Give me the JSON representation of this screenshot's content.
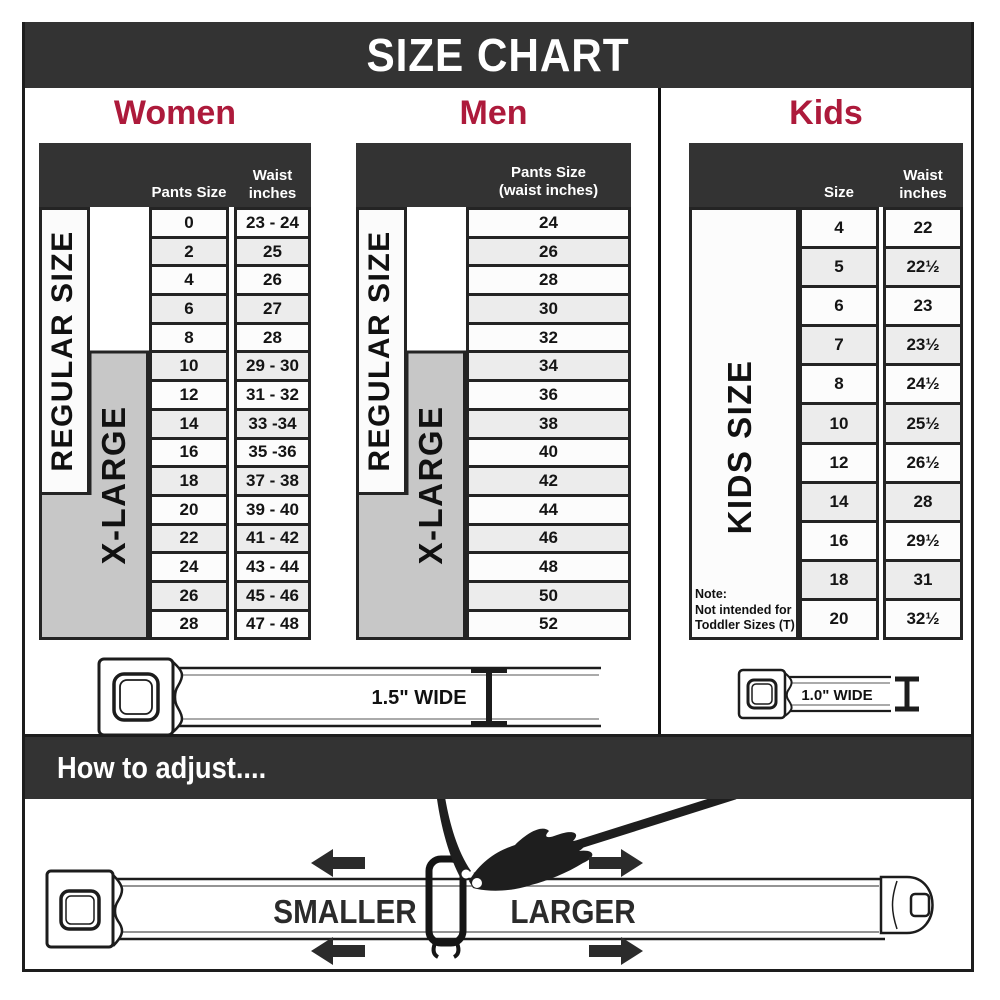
{
  "title": "SIZE CHART",
  "colors": {
    "accent": "#AD1A3B",
    "bar": "#333333",
    "xlarge_gray": "#C7C7C7"
  },
  "women": {
    "heading": "Women",
    "col_pants": "Pants Size",
    "col_waist_line1": "Waist",
    "col_waist_line2": "inches",
    "side_regular": "REGULAR SIZE",
    "side_xlarge": "X-LARGE",
    "rows": [
      {
        "size": "0",
        "waist": "23 - 24"
      },
      {
        "size": "2",
        "waist": "25"
      },
      {
        "size": "4",
        "waist": "26"
      },
      {
        "size": "6",
        "waist": "27"
      },
      {
        "size": "8",
        "waist": "28"
      },
      {
        "size": "10",
        "waist": "29 - 30"
      },
      {
        "size": "12",
        "waist": "31 - 32"
      },
      {
        "size": "14",
        "waist": "33 -34"
      },
      {
        "size": "16",
        "waist": "35 -36"
      },
      {
        "size": "18",
        "waist": "37 - 38"
      },
      {
        "size": "20",
        "waist": "39 - 40"
      },
      {
        "size": "22",
        "waist": "41 - 42"
      },
      {
        "size": "24",
        "waist": "43 - 44"
      },
      {
        "size": "26",
        "waist": "45 - 46"
      },
      {
        "size": "28",
        "waist": "47 - 48"
      }
    ]
  },
  "men": {
    "heading": "Men",
    "col_line1": "Pants Size",
    "col_line2": "(waist inches)",
    "side_regular": "REGULAR SIZE",
    "side_xlarge": "X-LARGE",
    "rows": [
      "24",
      "26",
      "28",
      "30",
      "32",
      "34",
      "36",
      "38",
      "40",
      "42",
      "44",
      "46",
      "48",
      "50",
      "52"
    ]
  },
  "kids": {
    "heading": "Kids",
    "col_size": "Size",
    "col_waist_line1": "Waist",
    "col_waist_line2": "inches",
    "side": "KIDS SIZE",
    "note_lines": [
      "Note:",
      "Not intended for",
      "Toddler Sizes (T)"
    ],
    "rows": [
      {
        "size": "4",
        "waist": "22"
      },
      {
        "size": "5",
        "waist": "22½"
      },
      {
        "size": "6",
        "waist": "23"
      },
      {
        "size": "7",
        "waist": "23½"
      },
      {
        "size": "8",
        "waist": "24½"
      },
      {
        "size": "10",
        "waist": "25½"
      },
      {
        "size": "12",
        "waist": "26½"
      },
      {
        "size": "14",
        "waist": "28"
      },
      {
        "size": "16",
        "waist": "29½"
      },
      {
        "size": "18",
        "waist": "31"
      },
      {
        "size": "20",
        "waist": "32½"
      }
    ]
  },
  "belts": {
    "adult_width_label": "1.5\" WIDE",
    "kids_width_label": "1.0\" WIDE"
  },
  "adjust": {
    "heading": "How to adjust....",
    "smaller": "SMALLER",
    "larger": "LARGER"
  }
}
